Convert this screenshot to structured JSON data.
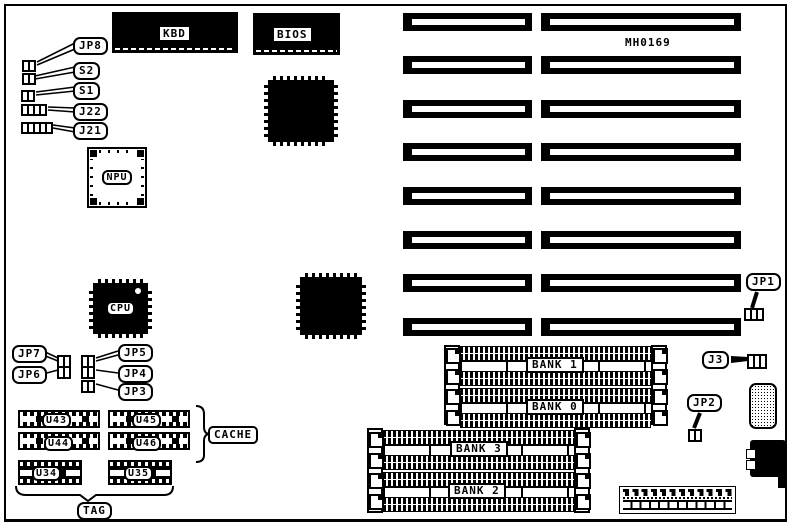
{
  "board": {
    "code": "MH0169",
    "slot_rows": 8
  },
  "chips": {
    "kbd": "KBD",
    "bios": "BIOS",
    "npu": "NPU",
    "cpu": "CPU"
  },
  "jumpers": {
    "jp8": "JP8",
    "s2": "S2",
    "s1": "S1",
    "j22": "J22",
    "j21": "J21",
    "jp7": "JP7",
    "jp6": "JP6",
    "jp5": "JP5",
    "jp4": "JP4",
    "jp3": "JP3",
    "jp1": "JP1",
    "j3": "J3",
    "jp2": "JP2"
  },
  "cache": {
    "u43": "U43",
    "u44": "U44",
    "u45": "U45",
    "u46": "U46",
    "u34": "U34",
    "u35": "U35",
    "group": "CACHE",
    "tag": "TAG"
  },
  "memory": {
    "bank1": "BANK 1",
    "bank0": "BANK 0",
    "bank3": "BANK 3",
    "bank2": "BANK 2"
  }
}
